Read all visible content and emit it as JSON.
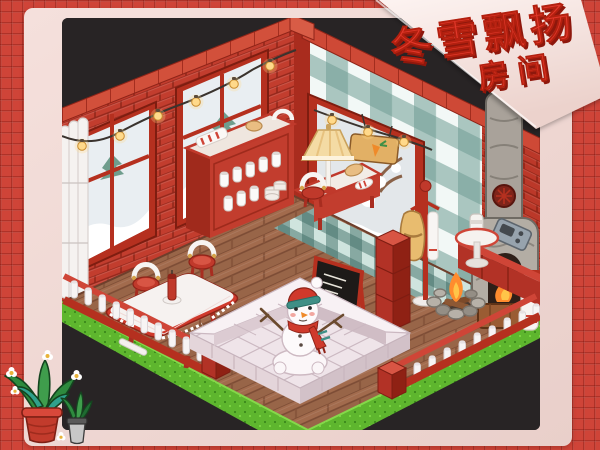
{
  "poster": {
    "banner": {
      "title": "冬雪飘扬",
      "subtitle": "房间",
      "text_color": "#e2372a",
      "text_shadow_color": "#8e170c",
      "ribbon_color": "#f7e7e3"
    },
    "frame": {
      "tile_color": "#cf4438",
      "grout_color": "#a22d1f",
      "mat_color": "#eed7d2"
    },
    "room": {
      "name": "winter-snow-isometric-room",
      "background": "#282425",
      "brick_color": "#c23d2e",
      "wallpaper_colors": [
        "#f2f8f6",
        "#cfe4df",
        "#9fc6be",
        "#6f9d93"
      ],
      "wood_floor_color": "#a26b4d",
      "tile_floor_colors": [
        "#cfe4de",
        "#7fa89f",
        "#4f726c"
      ],
      "grass_color": "#5eb62e",
      "snow_color": "#f6eef1",
      "fire_color": "#ff8c2e",
      "objects": [
        "left-windows",
        "white-curtains",
        "string-lights",
        "snow-view-window",
        "carrot-sign",
        "milk-bottle-counter",
        "table-lamp",
        "lamp-bench",
        "white-arch-chair",
        "dining-table",
        "candy-stools",
        "candle",
        "chalkboard-sign",
        "red-block-stack",
        "coat-rack",
        "hanging-towel",
        "round-side-table",
        "radio",
        "campfire",
        "stone-fireplace-chimney",
        "garland-fence",
        "snow-block-platform",
        "snowman",
        "grass-border"
      ]
    },
    "decor": {
      "plants": [
        "aloe-potted-plant",
        "small-potted-plant"
      ]
    }
  }
}
